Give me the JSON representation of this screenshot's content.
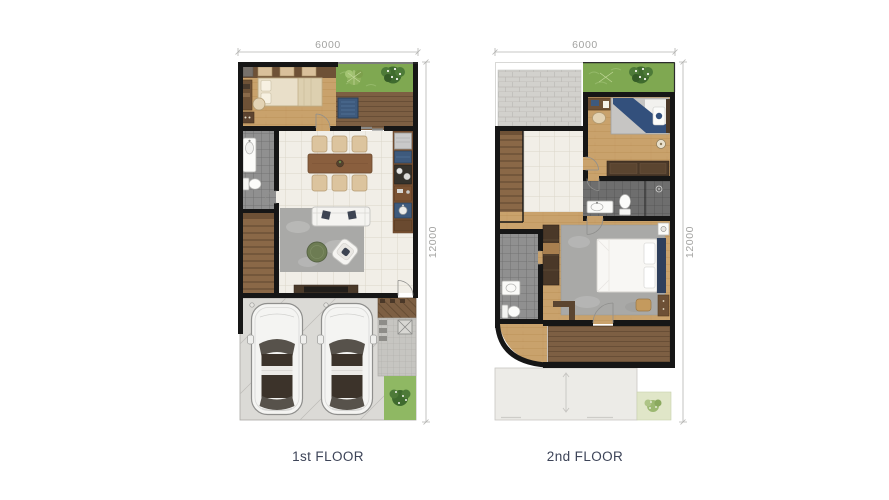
{
  "page": {
    "background_color": "#ffffff"
  },
  "floor1": {
    "label": "1st FLOOR",
    "dim_width": "6000",
    "dim_height": "12000",
    "features": [
      "bedroom",
      "bathroom",
      "stairs",
      "dining-area",
      "kitchen",
      "living-area",
      "terrace-deck",
      "garden",
      "carport",
      "two-cars",
      "side-paving",
      "rear-garden"
    ]
  },
  "floor2": {
    "label": "2nd FLOOR",
    "dim_width": "6000",
    "dim_height": "12000",
    "features": [
      "canopy-roof",
      "garden-void",
      "bedroom",
      "stairs",
      "hall",
      "bathroom",
      "master-bedroom",
      "ensuite-bathroom",
      "curved-wall",
      "balcony-deck",
      "carport-roof"
    ]
  },
  "colors": {
    "wall": "#161616",
    "wood_floor": "#c9a26c",
    "deck_wood": "#7d5f43",
    "dark_furniture": "#4a3828",
    "grass": "#7fa851",
    "pale_grass": "#e0e6c8",
    "tile_floor": "#f1eee7",
    "bath_tile": "#909090",
    "dark_bath_tile": "#6e6e6e",
    "rug": "#a9a9a7",
    "concrete": "#dbdad6",
    "paving": "#c6c5c1",
    "roof_tile": "#d2d1cd",
    "carport_roof": "#ecebe7",
    "accent_blue": "#3e5a7d",
    "headboard_navy": "#2e3f5c",
    "car_body": "#f4f4f2",
    "label_text": "#3d4458",
    "dimension_text": "#a3a3a1"
  }
}
